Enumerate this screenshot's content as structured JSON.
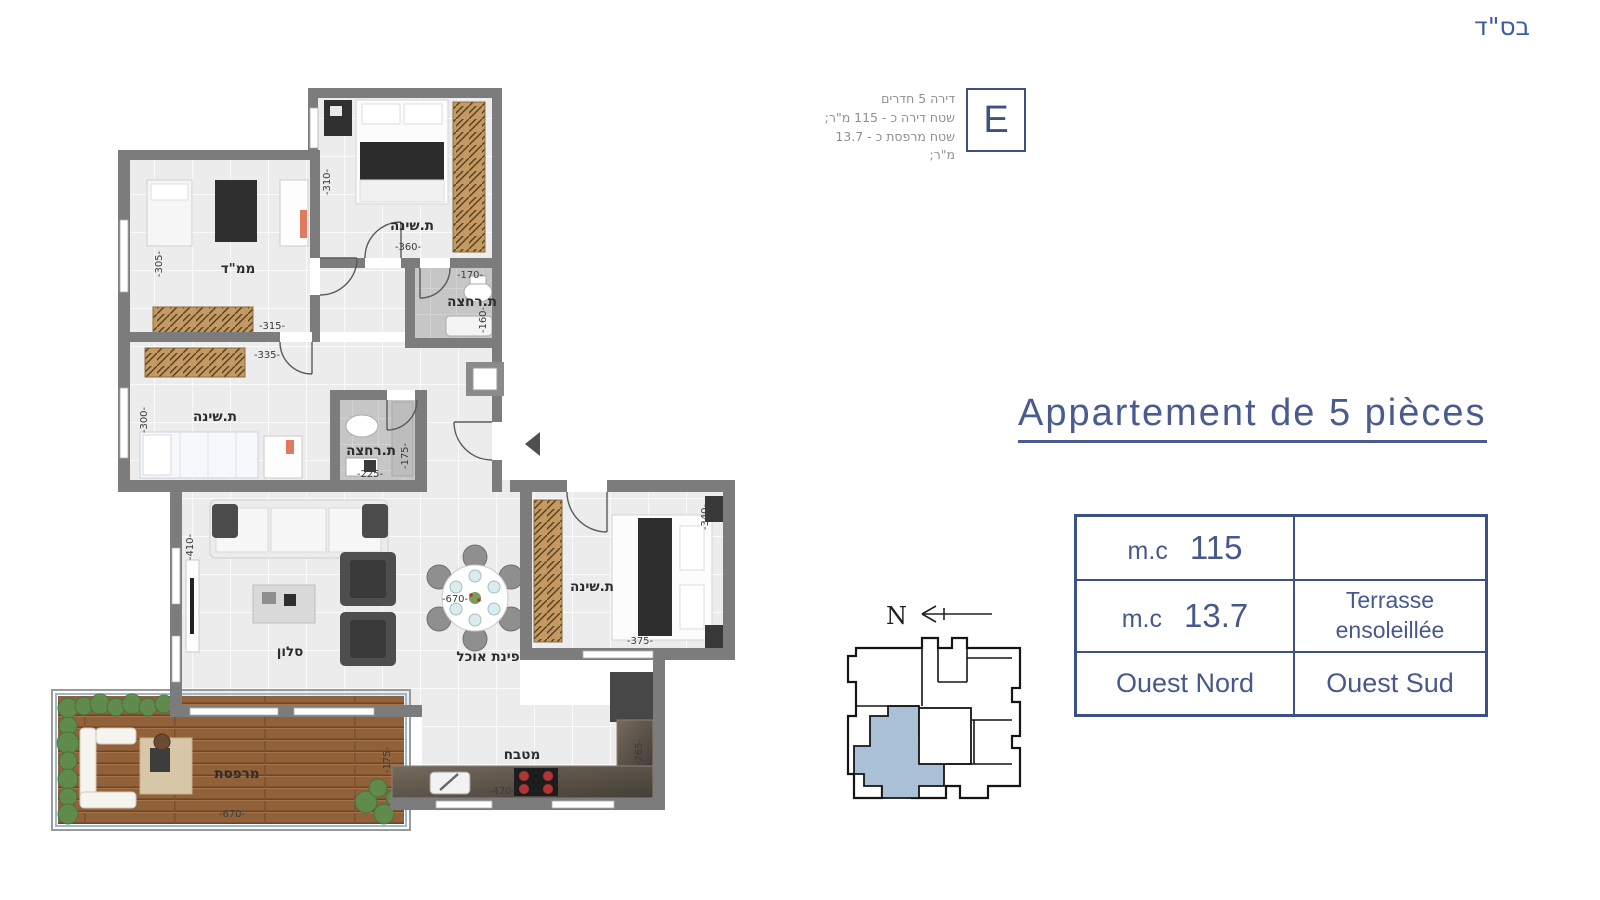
{
  "bsd": "בס\"ד",
  "header": {
    "line1": "דירה 5 חדרים",
    "line2": "שטח דירה כ - 115 מ\"ר;",
    "line3": "שטח מרפסת כ - 13.7 מ\"ר;",
    "unit_letter": "E"
  },
  "title": "Appartement de 5 pièces",
  "info_table": {
    "r1_unit": "m.c",
    "r1_value": "115",
    "r1_desc": "",
    "r2_unit": "m.c",
    "r2_value": "13.7",
    "r2_desc1": "Terrasse",
    "r2_desc2": "ensoleillée",
    "r3_left": "Ouest Nord",
    "r3_right": "Ouest Sud"
  },
  "key_plan": {
    "north": "N"
  },
  "plan": {
    "bedroom_top": {
      "name": "ת.שינה",
      "w": "-360-",
      "h": "-310-"
    },
    "mamad": {
      "name": "ממ\"ד",
      "w": "-315-",
      "h": "-305-"
    },
    "bath_top": {
      "name": "ת.רחצה",
      "w": "-170-",
      "h": "-160-"
    },
    "bedroom_mid": {
      "name": "ת.שינה",
      "w": "-335-",
      "h": "-300-"
    },
    "bath_mid": {
      "name": "ת.רחצה",
      "w": "-225-",
      "h": "-175-"
    },
    "salon": {
      "name": "סלון",
      "w": "-670-",
      "h": "-410-"
    },
    "dining": {
      "name": "פינת אוכל"
    },
    "bedroom_right": {
      "name": "ת.שינה",
      "w": "-375-",
      "h": "-340-"
    },
    "kitchen": {
      "name": "מטבח",
      "w": "-470-",
      "h": "-265-"
    },
    "terrace": {
      "name": "מרפסת",
      "w": "-670-",
      "h": "-175-"
    }
  },
  "colors": {
    "accent_blue": "#3c5285",
    "title_blue": "#4a5c8f",
    "wall_gray": "#7c7c7c",
    "key_highlight": "#a9c0d6"
  }
}
